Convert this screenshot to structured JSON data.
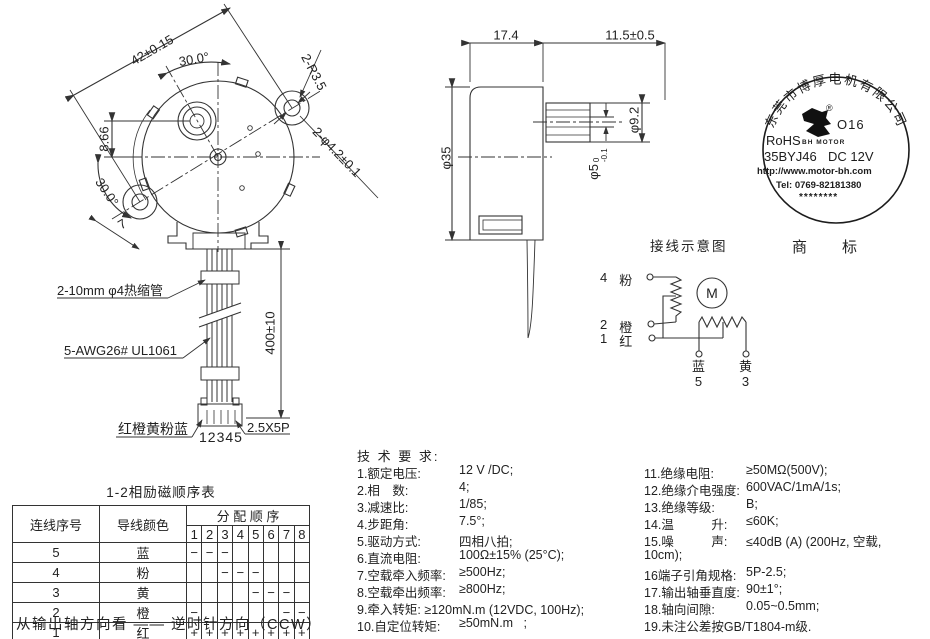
{
  "front_view": {
    "dim_width": "42±0.15",
    "dim_angle_top": "30.0°",
    "dim_offset": "8.66",
    "dim_angle_bottom": "30.0°",
    "dim_lug": "7",
    "dim_radius": "2-R3.5",
    "dim_holes": "2-φ4.2±0.1"
  },
  "side_view": {
    "dim_depth": "17.4",
    "dim_shaft_len": "11.5±0.5",
    "dim_body_dia": "φ35",
    "dim_bushing_dia": "φ9.2",
    "dim_shaft_dia": "φ5",
    "shaft_tol_top": "0",
    "shaft_tol_bottom": "-0.1"
  },
  "cable": {
    "heat_shrink_label": "2-10mm φ4热缩管",
    "wire_label": "5-AWG26# UL1061",
    "dim_length": "400±10",
    "wire_colors": "红橙黄粉蓝",
    "pin_numbers": "12345",
    "connector_label": "2.5X5P"
  },
  "stamp": {
    "company": "东莞市博厚电机有限公司",
    "reg": "®",
    "code": "O16",
    "logo_caption": "BH MOTOR",
    "rohs": "RoHS",
    "model": "35BYJ46",
    "voltage": "DC 12V",
    "url": "http://www.motor-bh.com",
    "tel": "Tel: 0769-82181380",
    "stars": "********"
  },
  "trademark": "商标",
  "wiring": {
    "title": "接线示意图",
    "motor_symbol": "M",
    "t4_num": "4",
    "t4_color": "粉",
    "t2_num": "2",
    "t2_color": "橙",
    "t1_num": "1",
    "t1_color": "红",
    "t5_num": "5",
    "t5_color": "蓝",
    "t3_num": "3",
    "t3_color": "黄"
  },
  "tech": {
    "title": "技 术 要 求:",
    "left": [
      {
        "label": "1.额定电压:",
        "value": "12 V /DC;"
      },
      {
        "label": "2.相　数:",
        "value": "4;"
      },
      {
        "label": "3.减速比:",
        "value": "1/85;"
      },
      {
        "label": "4.步距角:",
        "value": "7.5°;"
      },
      {
        "label": "5.驱动方式:",
        "value": "四相八拍;"
      },
      {
        "label": "6.直流电阻:",
        "value": "100Ω±15% (25°C);"
      },
      {
        "label": "7.空载牵入频率:",
        "value": "≥500Hz;"
      },
      {
        "label": "8.空载牵出频率:",
        "value": "≥800Hz;"
      },
      {
        "label": "9.牵入转矩: ≥120mN.m (12VDC, 100Hz);",
        "value": ""
      },
      {
        "label": "10.自定位转矩:",
        "value": "≥50mN.m   ;"
      }
    ],
    "right": [
      {
        "label": "11.绝缘电阻:",
        "value": "≥50MΩ(500V);"
      },
      {
        "label": "12.绝缘介电强度:",
        "value": "600VAC/1mA/1s;"
      },
      {
        "label": "13.绝缘等级:",
        "value": "B;"
      },
      {
        "label": "14.温　　　升:",
        "value": "≤60K;"
      },
      {
        "label": "15.噪　　　声:",
        "value": "≤40dB (A) (200Hz, 空载,"
      },
      {
        "label": "10cm);",
        "value": ""
      },
      {
        "label": "16端子引角规格:",
        "value": "5P-2.5;"
      },
      {
        "label": "17.输出轴垂直度:",
        "value": "90±1°;"
      },
      {
        "label": "18.轴向间隙:",
        "value": "0.05~0.5mm;"
      },
      {
        "label": "19.未注公差按GB/T1804-m级.",
        "value": ""
      }
    ]
  },
  "seq_table": {
    "title": "1-2相励磁顺序表",
    "h_wire_no": "连线序号",
    "h_wire_color": "导线颜色",
    "h_sequence": "分 配 顺 序",
    "steps": [
      "1",
      "2",
      "3",
      "4",
      "5",
      "6",
      "7",
      "8"
    ],
    "rows": [
      {
        "no": "5",
        "color": "蓝",
        "cells": [
          "−",
          "−",
          "−",
          "",
          "",
          "",
          "",
          ""
        ]
      },
      {
        "no": "4",
        "color": "粉",
        "cells": [
          "",
          "",
          "−",
          "−",
          "−",
          "",
          "",
          ""
        ]
      },
      {
        "no": "3",
        "color": "黄",
        "cells": [
          "",
          "",
          "",
          "",
          "−",
          "−",
          "−",
          ""
        ]
      },
      {
        "no": "2",
        "color": "橙",
        "cells": [
          "−",
          "",
          "",
          "",
          "",
          "",
          "−",
          "−"
        ]
      },
      {
        "no": "1",
        "color": "红",
        "cells": [
          "+",
          "+",
          "+",
          "+",
          "+",
          "+",
          "+",
          "+"
        ]
      }
    ]
  },
  "footer": "从输出轴方向看 —— 逆时针方向（CCW）"
}
